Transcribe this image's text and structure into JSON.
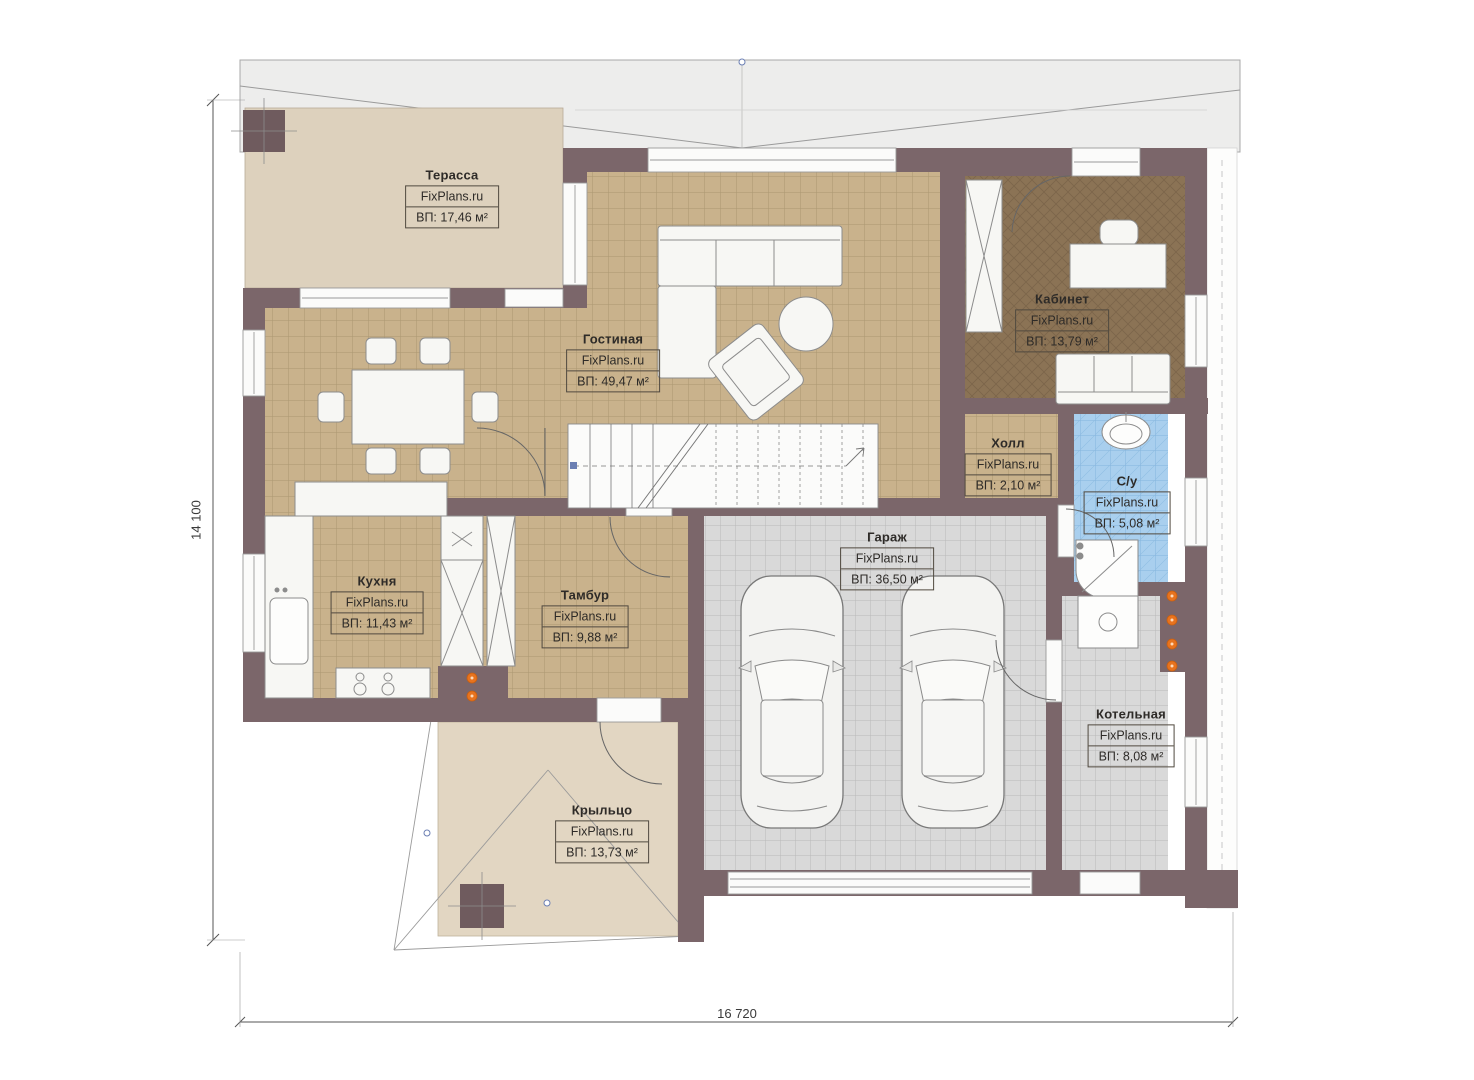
{
  "plan": {
    "source_brand": "FixPlans.ru",
    "dimensions": {
      "height": "14 100",
      "width": "16 720"
    },
    "rooms": [
      {
        "key": "terrace",
        "name": "Терасса",
        "brand": "FixPlans.ru",
        "area": "ВП: 17,46 м²"
      },
      {
        "key": "living",
        "name": "Гостиная",
        "brand": "FixPlans.ru",
        "area": "ВП: 49,47 м²"
      },
      {
        "key": "office",
        "name": "Кабинет",
        "brand": "FixPlans.ru",
        "area": "ВП: 13,79 м²"
      },
      {
        "key": "hall",
        "name": "Холл",
        "brand": "FixPlans.ru",
        "area": "ВП: 2,10 м²"
      },
      {
        "key": "bathroom",
        "name": "С/у",
        "brand": "FixPlans.ru",
        "area": "ВП: 5,08 м²"
      },
      {
        "key": "kitchen",
        "name": "Кухня",
        "brand": "FixPlans.ru",
        "area": "ВП: 11,43 м²"
      },
      {
        "key": "vestibule",
        "name": "Тамбур",
        "brand": "FixPlans.ru",
        "area": "ВП: 9,88 м²"
      },
      {
        "key": "garage",
        "name": "Гараж",
        "brand": "FixPlans.ru",
        "area": "ВП: 36,50 м²"
      },
      {
        "key": "boiler",
        "name": "Котельная",
        "brand": "FixPlans.ru",
        "area": "ВП: 8,08 м²"
      },
      {
        "key": "porch",
        "name": "Крыльцо",
        "brand": "FixPlans.ru",
        "area": "ВП: 13,73 м²"
      }
    ],
    "colors": {
      "wall": "#7b666a",
      "tan_floor": "#c9b28c",
      "gray_floor": "#d9d9d9",
      "blue_floor": "#a9cfee",
      "office_floor": "#8b7355",
      "terrace_floor": "#ddd1bd",
      "porch_floor": "#e2d6c2",
      "radiator_orange": "#e8731e"
    }
  }
}
